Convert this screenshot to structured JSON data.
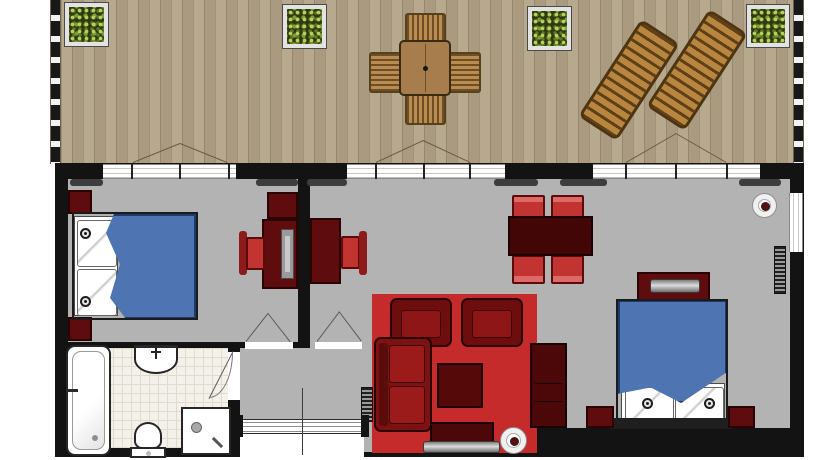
{
  "meta": {
    "type": "apartment-floor-plan",
    "orientation": "terrace-on-top",
    "visible_text": "none"
  },
  "colors": {
    "deck_wood": "#b7a98d",
    "deck_wood_dark": "#aa9b80",
    "railing_dark": "#181818",
    "wall": "#131313",
    "room_floor": "#b3b3b3",
    "bathroom_tile": "#f4f1ea",
    "rug_red": "#c52b2b",
    "furniture_dark_red": "#5f0c0e",
    "furniture_maroon": "#4c0808",
    "chair_red": "#c23431",
    "bed_blue": "#4e74b1",
    "foliage_green": "#7d9c33",
    "lounger_wood": "#b9863f"
  },
  "areas": [
    {
      "id": "terrace",
      "items": [
        "planter-box-1",
        "planter-box-2",
        "planter-box-3",
        "planter-box-4",
        "wooden-dining-table",
        "wooden-chair-top",
        "wooden-chair-bottom",
        "wooden-chair-left",
        "wooden-chair-right",
        "sun-lounger-1",
        "sun-lounger-2",
        "double-door-left",
        "double-door-center",
        "double-door-right"
      ]
    },
    {
      "id": "bedroom-left",
      "items": [
        "double-bed",
        "pillow-pair",
        "bedside-lamp-1",
        "bedside-lamp-2",
        "wardrobe-top",
        "wardrobe-bottom",
        "desk",
        "laptop",
        "desk-chair",
        "wall-cabinet"
      ]
    },
    {
      "id": "living-room",
      "items": [
        "desk",
        "desk-chair",
        "dining-table",
        "dining-chair-1",
        "dining-chair-2",
        "dining-chair-3",
        "dining-chair-4",
        "red-rug",
        "armchair-1",
        "armchair-2",
        "coffee-table",
        "sofa",
        "tv-stand",
        "tv",
        "floor-lamp",
        "tall-cabinet",
        "ceiling-lamp",
        "radiator-hall"
      ]
    },
    {
      "id": "bedroom-right",
      "items": [
        "double-bed",
        "pillow-pair",
        "bedside-lamp-1",
        "bedside-lamp-2",
        "dresser",
        "dresser-tv",
        "nightstand-left",
        "nightstand-right",
        "radiator",
        "side-window"
      ]
    },
    {
      "id": "bathroom",
      "items": [
        "bathtub",
        "sink",
        "toilet",
        "shower",
        "door-swing"
      ]
    },
    {
      "id": "hall",
      "items": [
        "entrance-sliding-door",
        "door-to-bedroom",
        "door-to-living-room"
      ]
    }
  ],
  "counts": {
    "planters": 4,
    "sun_loungers": 2,
    "beds": 2,
    "dining_chairs_inside": 4,
    "deck_chairs": 4
  }
}
